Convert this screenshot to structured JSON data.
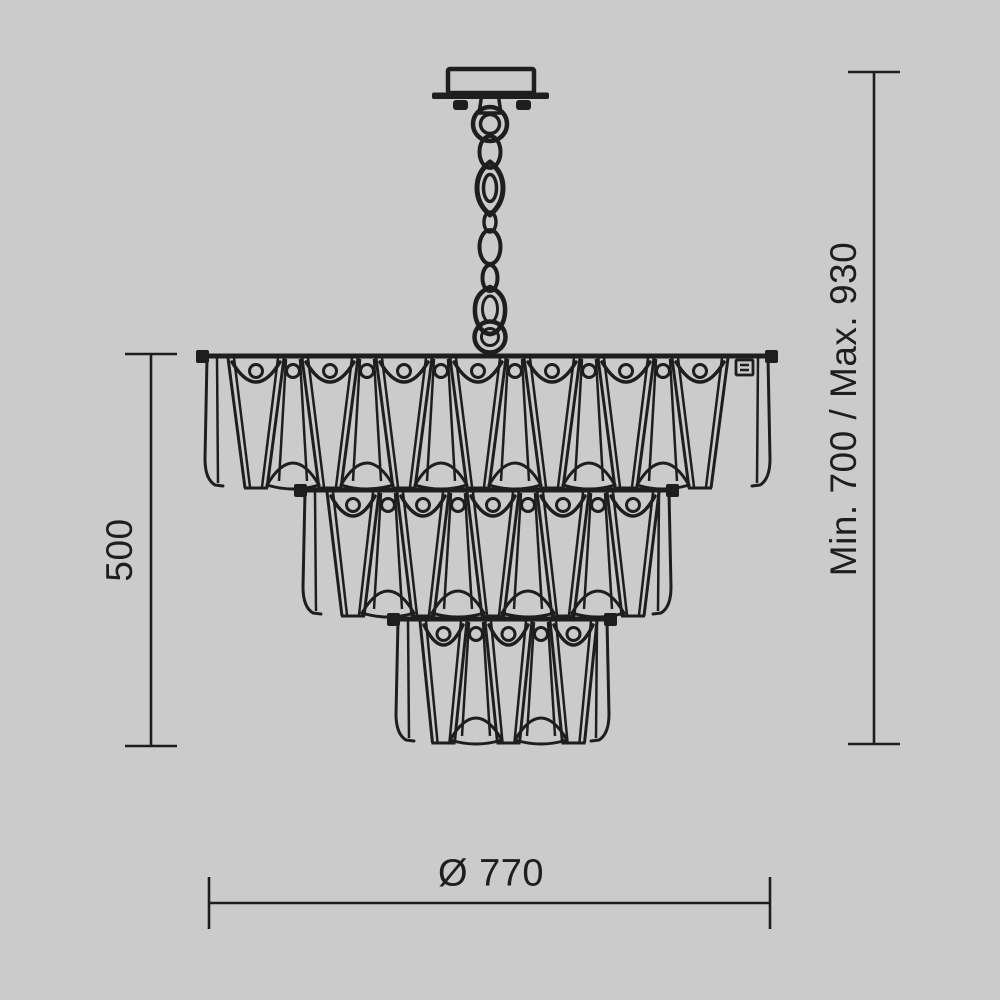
{
  "colors": {
    "background": "#cbcbcb",
    "ink": "#1f1d1e"
  },
  "dimensions": {
    "height_label": "500",
    "suspension_label": "Min. 700 / Max. 930",
    "diameter_label": "Ø 770"
  },
  "figure": {
    "type": "technical-line-drawing",
    "subject": "three-tier crystal chandelier with ceiling canopy and chain suspension",
    "chain": {
      "cx": 490,
      "canopy_top": 69,
      "hook_bottom": 353
    },
    "tiers": [
      {
        "left": 203,
        "right": 772,
        "top": 356,
        "bottom": 489,
        "crystals": 7,
        "edge_left": 25,
        "edge_right": 44,
        "clip": true
      },
      {
        "left": 301,
        "right": 673,
        "top": 490,
        "bottom": 617,
        "crystals": 5,
        "edge_left": 26,
        "edge_right": 14,
        "clip": false
      },
      {
        "left": 394,
        "right": 611,
        "top": 619,
        "bottom": 744,
        "crystals": 3,
        "edge_left": 26,
        "edge_right": 14,
        "clip": false
      }
    ],
    "dimension_lines": {
      "left": {
        "x": 151,
        "y1": 354,
        "y2": 746,
        "cap": 52
      },
      "right": {
        "x": 874,
        "y1": 72,
        "y2": 744,
        "cap": 52
      },
      "bottom": {
        "y": 903,
        "x1": 209,
        "x2": 770,
        "cap": 52
      }
    }
  }
}
